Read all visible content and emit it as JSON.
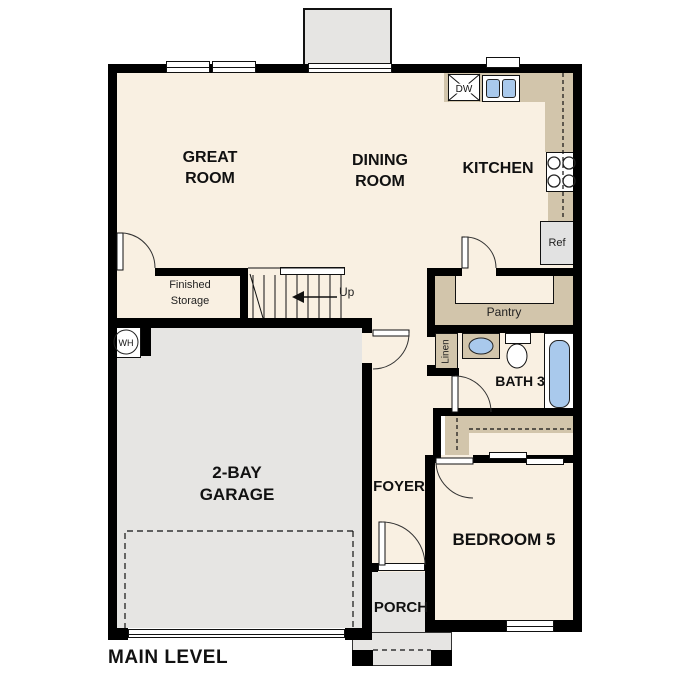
{
  "plan": {
    "title": "MAIN LEVEL",
    "rooms": {
      "great_room": "GREAT ROOM",
      "dining_room": "DINING ROOM",
      "kitchen": "KITCHEN",
      "finished_storage": "Finished Storage",
      "garage": "2-BAY GARAGE",
      "foyer": "FOYER",
      "bedroom5": "BEDROOM 5",
      "bath3": "BATH 3",
      "porch": "PORCH"
    },
    "labels": {
      "pantry": "Pantry",
      "linen": "Linen",
      "up": "Up",
      "dishwasher": "DW",
      "refrigerator": "Ref",
      "water_heater": "WH"
    },
    "colors": {
      "floor": "#f9f0e2",
      "counter_tan": "#d2c5ab",
      "garage_gray": "#e6e5e3",
      "fixture_blue": "#a9c9ec",
      "wall_black": "#000000"
    }
  }
}
